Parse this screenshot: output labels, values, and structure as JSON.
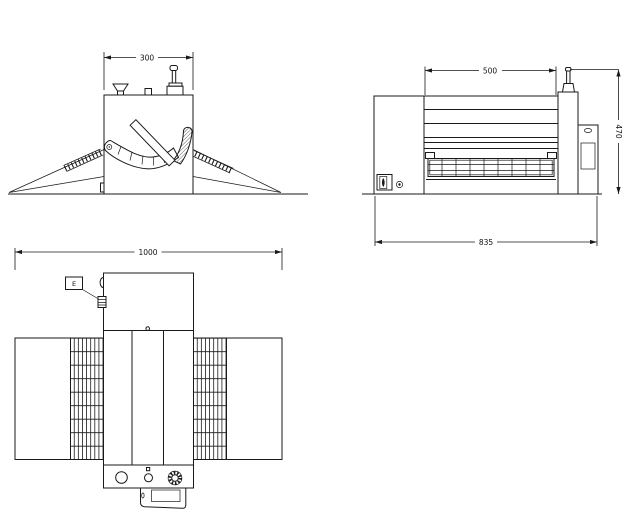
{
  "drawing": {
    "background": "#ffffff",
    "line_color": "#1a1a1a",
    "side_view": {
      "width_dim": "300"
    },
    "front_view": {
      "roller_width_dim": "500",
      "height_dim": "470",
      "overall_width_dim": "835"
    },
    "plan_view": {
      "overall_length_dim": "1000",
      "connector_label": "E"
    }
  }
}
